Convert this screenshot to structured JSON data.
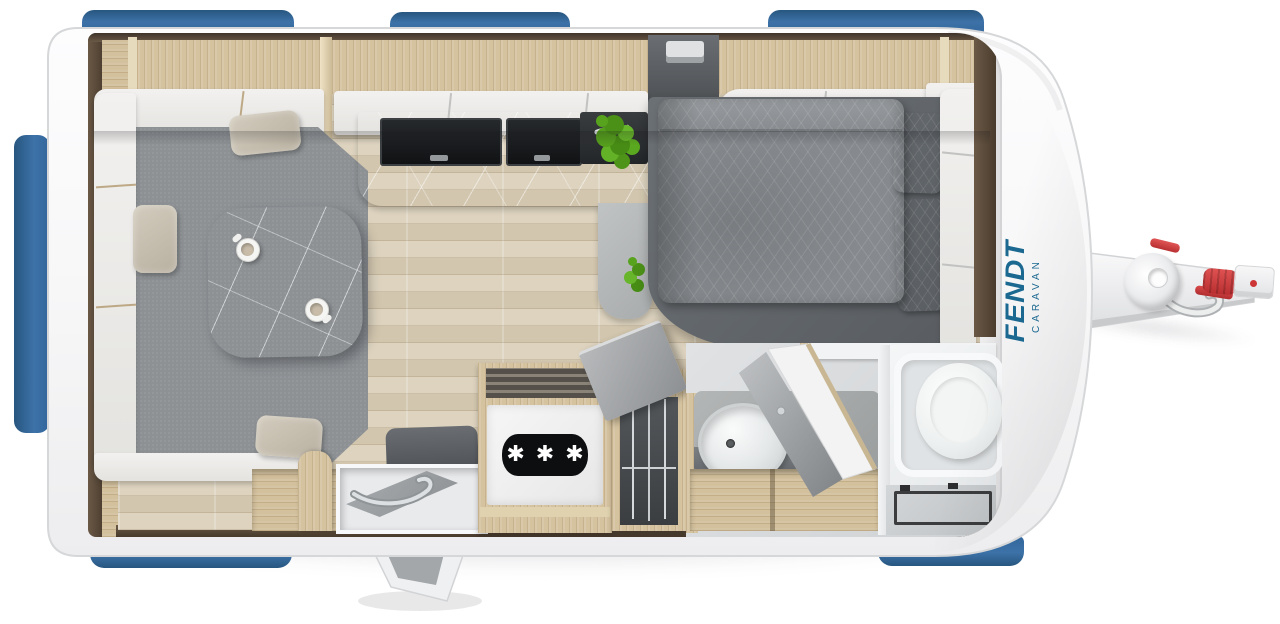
{
  "branding": {
    "name": "FENDT",
    "sub": "CARAVAN",
    "brand_color": "#1b6890"
  },
  "appliances": {
    "fridge_badge": "✱ ✱ ✱"
  },
  "colors": {
    "window_blue": "#3d72a8",
    "body_white": "#f6f6f7",
    "wood_light": "#d5c3a0",
    "walnut_dark": "#4a3c2e",
    "floor_plank": "#d9cfba",
    "upholstery_gray": "#8f9396",
    "cushion_beige": "#c9c1b1",
    "counter_marble": "#b9bcbd",
    "bed_gray": "#85898d",
    "hitch_red": "#cf3a3a"
  },
  "floorplan": {
    "vehicle": "caravan",
    "view": "top-down",
    "areas": {
      "dinette": {
        "label": "U-shaped lounge with table",
        "cups": 2,
        "pillows": 3
      },
      "kitchen": {
        "label": "Kitchen block with two glass covers and plant",
        "covers": 2
      },
      "entry": {
        "label": "Entrance with open door"
      },
      "fridge": {
        "label": "Refrigerator with freezer badge"
      },
      "storage": {
        "label": "Open storage locker with wire racks"
      },
      "bed": {
        "label": "Double bed with duvet",
        "pillows": 2
      },
      "bathroom": {
        "label": "Washroom with basin, toilet and shower tray"
      },
      "hitch": {
        "label": "Drawbar and coupling"
      }
    }
  }
}
